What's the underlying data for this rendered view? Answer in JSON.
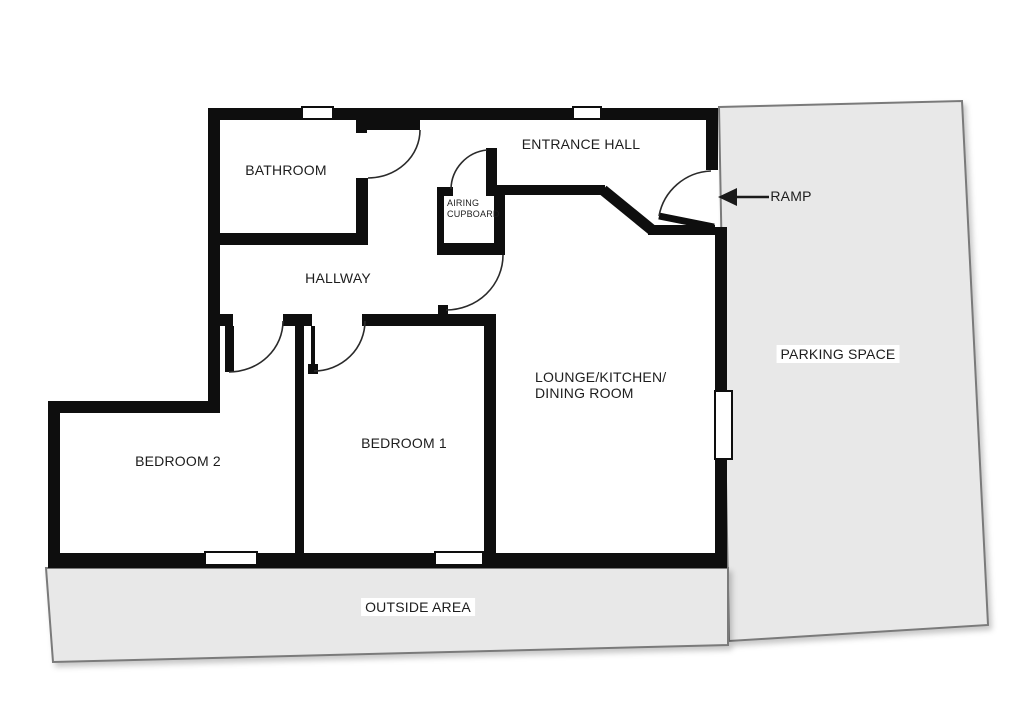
{
  "title": "Floor plan",
  "labels": {
    "bathroom": "BATHROOM",
    "entrance_hall": "ENTRANCE HALL",
    "hallway": "HALLWAY",
    "airing_line1": "AIRING",
    "airing_line2": "CUPBOARD",
    "lounge_line1": "LOUNGE/KITCHEN/",
    "lounge_line2": "DINING ROOM",
    "bedroom1": "BEDROOM 1",
    "bedroom2": "BEDROOM 2",
    "outside_area": "OUTSIDE AREA",
    "parking_space": "PARKING SPACE",
    "ramp": "RAMP"
  },
  "colors": {
    "wall": "#0e0e0e",
    "area_fill": "#e8e8e8",
    "area_border": "#7a7a7a",
    "text": "#1d1d1d",
    "background": "#ffffff"
  }
}
